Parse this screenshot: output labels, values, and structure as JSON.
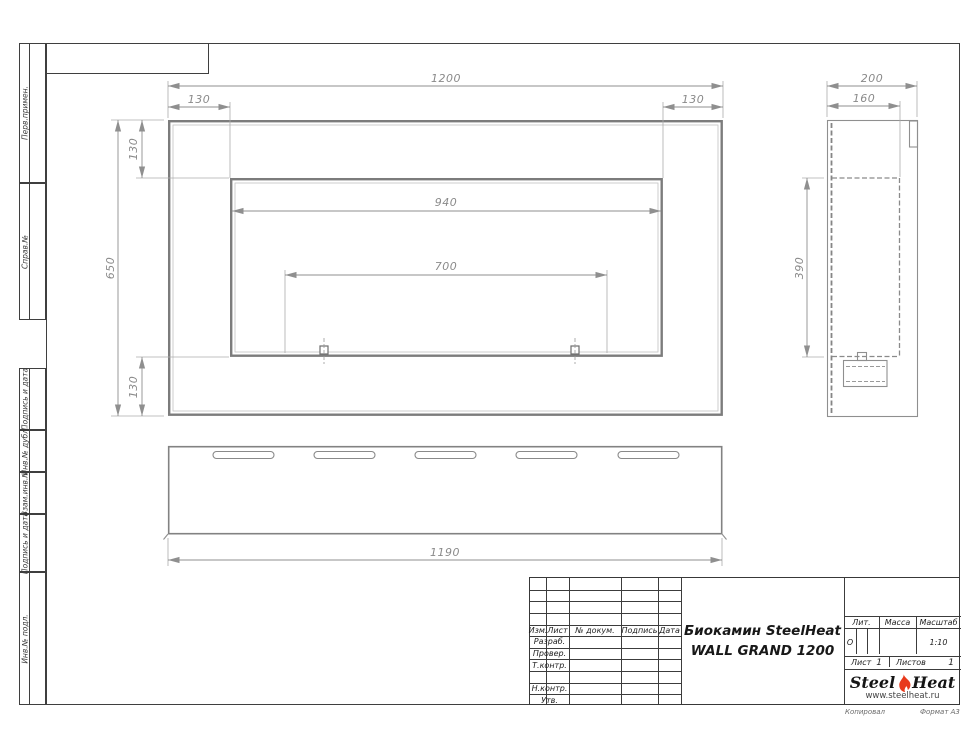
{
  "sheet": {
    "copied_label": "Копировал",
    "format_label": "Формат А3"
  },
  "margin_labels": {
    "perv": "Перв.примен.",
    "sprav": "Справ.№",
    "podpis1": "Подпись и дата",
    "inv_dubl": "Инв.№ дубл.",
    "vzam": "Взам.инв.№",
    "podpis2": "Подпись и дата",
    "inv_podl": "Инв.№ подл."
  },
  "views": {
    "front": {
      "width": "1200",
      "left_offset": "130",
      "right_offset": "130",
      "height": "650",
      "top_offset": "130",
      "bottom_offset": "130",
      "opening_width": "940",
      "mount_width": "700"
    },
    "side": {
      "depth": "200",
      "inner_depth": "160",
      "opening_height": "390"
    },
    "bottom": {
      "length": "1190"
    }
  },
  "title_block": {
    "cols": {
      "izm": "Изм.",
      "list": "Лист",
      "doc": "№ докум.",
      "sign": "Подпись",
      "date": "Дата"
    },
    "rows": {
      "razrab": "Разраб.",
      "prover": "Провер.",
      "tkontr": "Т.контр.",
      "nkontr": "Н.контр.",
      "utv": "Утв."
    },
    "title_line1": "Биокамин SteelHeat",
    "title_line2": "WALL GRAND 1200",
    "lit_label": "Лит.",
    "lit_value": "О",
    "mass_label": "Масса",
    "scale_label": "Масштаб",
    "scale_value": "1:10",
    "sheet_label": "Лист",
    "sheet_value": "1",
    "sheets_label": "Листов",
    "sheets_value": "1"
  },
  "logo": {
    "steel": "Steel",
    "heat": "Heat",
    "site": "www.steelheat.ru"
  }
}
